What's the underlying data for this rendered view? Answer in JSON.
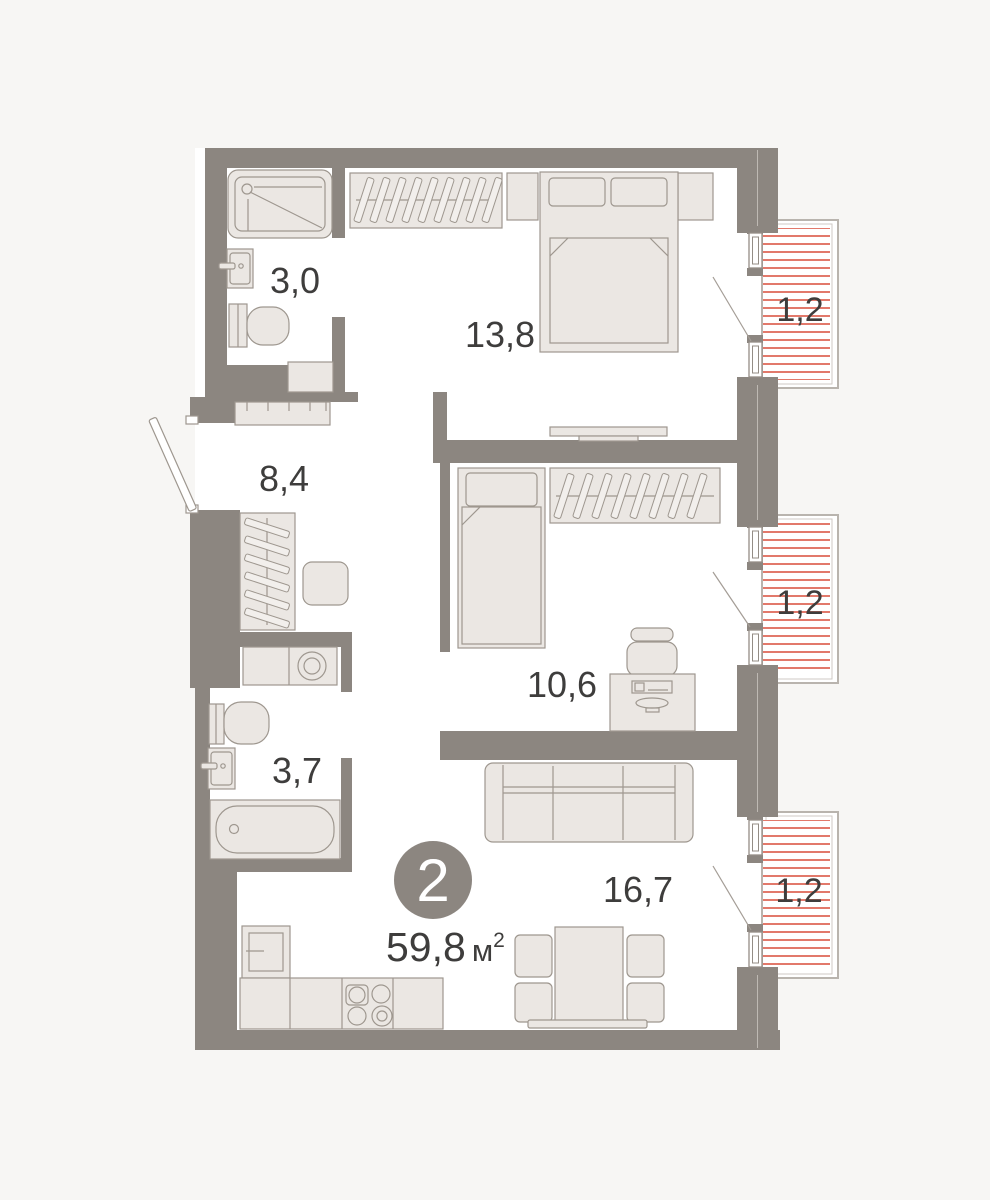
{
  "plan": {
    "unit": {
      "number": "2",
      "area": "59,8",
      "area_unit": "м",
      "area_exponent": "2"
    },
    "rooms": {
      "shower_room": {
        "area": "3,0"
      },
      "bedroom_main": {
        "area": "13,8"
      },
      "hallway": {
        "area": "8,4"
      },
      "bedroom_second": {
        "area": "10,6"
      },
      "bathroom": {
        "area": "3,7"
      },
      "living_kitchen": {
        "area": "16,7"
      },
      "balcony_top": {
        "area": "1,2"
      },
      "balcony_middle": {
        "area": "1,2"
      },
      "balcony_bottom": {
        "area": "1,2"
      }
    },
    "colors": {
      "wall": "#8c8680",
      "furniture_fill": "#ebe7e3",
      "furniture_stroke": "#9e978f",
      "balcony_stripe": "#e2796b",
      "text": "#3e3d3c",
      "badge": "#8c8680",
      "floor": "#ffffff",
      "background": "#f7f6f4"
    }
  }
}
